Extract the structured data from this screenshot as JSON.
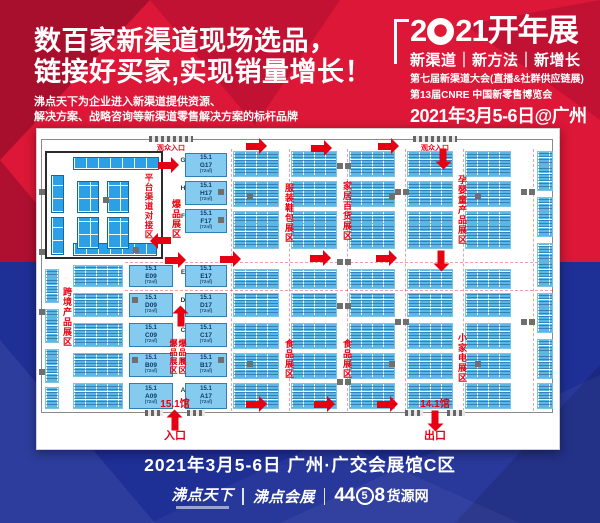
{
  "colors": {
    "accent_red": "#e60012",
    "bg_red": "#dc1737",
    "bg_blue": "#1e2f96",
    "booth_blue": "#59b8ea"
  },
  "hero": {
    "headline1": "数百家新渠道现场选品，",
    "headline2": "链接好买家,实现销量增长！",
    "sub1": "沸点天下为企业进入新渠道提供资源、",
    "sub2": "解决方案、战略咨询等新渠道零售解决方案的标杆品牌"
  },
  "event": {
    "title_pre": "2",
    "title_post": "21开年展",
    "tagline": "新渠道｜新方法｜新增长",
    "line1": "第七届新渠道大会(直播&社群供应链展)",
    "line2": "第13届CNRE 中国新零售博览会",
    "date": "2021年3月5-6日@广州"
  },
  "footer": {
    "venue": "2021年3月5-6日 广州·广交会展馆C区",
    "logo1": "沸点天下",
    "logo2": "沸点会展",
    "logo3_pre": "44",
    "logo3_circle": "5",
    "logo3_post": "8",
    "logo3_suffix": "货源网"
  },
  "floorplan": {
    "prefix": "15.1",
    "area_label": "(72㎡)",
    "wall": [
      4,
      10,
      512,
      274
    ],
    "room": {
      "x": 8,
      "y": 22,
      "w": 118,
      "h": 108,
      "label": "平台渠道对接区",
      "label_x": 94,
      "label_y": 20,
      "label_h": 84,
      "strips": [
        [
          26,
          4,
          86,
          13
        ],
        [
          4,
          22,
          13,
          38
        ],
        [
          4,
          64,
          13,
          38
        ],
        [
          26,
          90,
          84,
          13
        ]
      ],
      "clusters": [
        [
          30,
          28,
          22,
          32
        ],
        [
          60,
          28,
          22,
          32
        ],
        [
          30,
          64,
          22,
          32
        ],
        [
          60,
          64,
          22,
          32
        ]
      ],
      "pillars": [
        [
          56,
          44
        ],
        [
          86,
          94
        ]
      ]
    },
    "block_cols": [
      196,
      254,
      312,
      370,
      428
    ],
    "block_w": 46,
    "block_rows": [
      [
        22,
        26
      ],
      [
        52,
        26
      ],
      [
        82,
        38
      ],
      [
        140,
        20
      ],
      [
        164,
        24
      ],
      [
        194,
        26
      ],
      [
        224,
        26
      ],
      [
        254,
        26
      ]
    ],
    "blocks_extra": [
      [
        500,
        22,
        16,
        40
      ],
      [
        500,
        68,
        16,
        40
      ],
      [
        500,
        114,
        16,
        44
      ],
      [
        500,
        164,
        16,
        40
      ],
      [
        500,
        210,
        16,
        40
      ],
      [
        500,
        254,
        16,
        26
      ],
      [
        36,
        136,
        50,
        22
      ],
      [
        36,
        164,
        50,
        24
      ],
      [
        36,
        194,
        50,
        24
      ],
      [
        36,
        224,
        50,
        24
      ],
      [
        36,
        254,
        50,
        26
      ],
      [
        8,
        140,
        14,
        34
      ],
      [
        8,
        180,
        14,
        34
      ],
      [
        8,
        220,
        14,
        34
      ],
      [
        8,
        258,
        14,
        22
      ]
    ],
    "big_booths": [
      [
        "G17",
        148,
        24,
        42,
        24
      ],
      [
        "H17",
        148,
        52,
        42,
        24
      ],
      [
        "F17",
        148,
        80,
        42,
        24
      ],
      [
        "E17",
        148,
        136,
        42,
        22
      ],
      [
        "D17",
        148,
        164,
        42,
        24
      ],
      [
        "C17",
        148,
        194,
        42,
        24
      ],
      [
        "B17",
        148,
        224,
        42,
        24
      ],
      [
        "A17",
        148,
        254,
        42,
        26
      ],
      [
        "E09",
        92,
        136,
        44,
        22
      ],
      [
        "D09",
        92,
        164,
        44,
        24
      ],
      [
        "C09",
        92,
        194,
        44,
        24
      ],
      [
        "B09",
        92,
        224,
        44,
        24
      ],
      [
        "A09",
        92,
        254,
        44,
        26
      ]
    ],
    "letters_x": 141,
    "row_letters": [
      [
        "G",
        28
      ],
      [
        "H",
        56
      ],
      [
        "F",
        84
      ],
      [
        "E",
        140
      ],
      [
        "D",
        168
      ],
      [
        "C",
        198
      ],
      [
        "B",
        228
      ],
      [
        "A",
        258
      ]
    ],
    "zones": [
      [
        "爆品展区",
        131,
        70,
        9
      ],
      [
        "服装鞋包展区",
        244,
        54,
        9
      ],
      [
        "家居百货展区",
        302,
        52,
        9
      ],
      [
        "孕婴童产品展区",
        417,
        46,
        9
      ],
      [
        "跨境产品展区",
        22,
        158,
        9
      ],
      [
        "爆品展区",
        128,
        210,
        8
      ],
      [
        "爆品展区",
        137,
        210,
        8
      ],
      [
        "食品展区",
        244,
        210,
        9
      ],
      [
        "食品展区",
        302,
        210,
        9
      ],
      [
        "小家电展区",
        417,
        204,
        9
      ]
    ],
    "arrows": [
      [
        209,
        14,
        "right"
      ],
      [
        274,
        16,
        "right"
      ],
      [
        341,
        14,
        "right"
      ],
      [
        396,
        26,
        "down"
      ],
      [
        121,
        33,
        "right"
      ],
      [
        114,
        108,
        "left"
      ],
      [
        128,
        128,
        "right"
      ],
      [
        183,
        127,
        "right"
      ],
      [
        273,
        126,
        "right"
      ],
      [
        339,
        126,
        "right"
      ],
      [
        394,
        128,
        "down"
      ],
      [
        134,
        184,
        "up"
      ],
      [
        209,
        272,
        "right"
      ],
      [
        277,
        272,
        "right"
      ],
      [
        340,
        272,
        "right"
      ]
    ],
    "pillars": [
      [
        300,
        34
      ],
      [
        308,
        34
      ],
      [
        300,
        130
      ],
      [
        308,
        130
      ],
      [
        300,
        174
      ],
      [
        308,
        174
      ],
      [
        300,
        250
      ],
      [
        308,
        250
      ],
      [
        358,
        60
      ],
      [
        366,
        60
      ],
      [
        358,
        190
      ],
      [
        366,
        190
      ],
      [
        484,
        60
      ],
      [
        492,
        60
      ],
      [
        484,
        190
      ],
      [
        492,
        190
      ],
      [
        181,
        60
      ],
      [
        181,
        88
      ],
      [
        95,
        168
      ],
      [
        95,
        228
      ],
      [
        181,
        228
      ],
      [
        210,
        64
      ],
      [
        352,
        64
      ],
      [
        438,
        64
      ],
      [
        210,
        232
      ],
      [
        352,
        232
      ],
      [
        438,
        232
      ],
      [
        2,
        60
      ],
      [
        2,
        120
      ],
      [
        2,
        180
      ],
      [
        2,
        240
      ]
    ],
    "dash_v": [
      194,
      252,
      310,
      368,
      426,
      496
    ],
    "dash_h": [
      133,
      161
    ],
    "entrances_top": [
      [
        "观众入口",
        112
      ],
      [
        "观众入口",
        376
      ]
    ],
    "gates": [
      [
        "15.1馆",
        "入口",
        138,
        "up"
      ],
      [
        "14.1馆",
        "出口",
        398,
        "down"
      ]
    ]
  }
}
